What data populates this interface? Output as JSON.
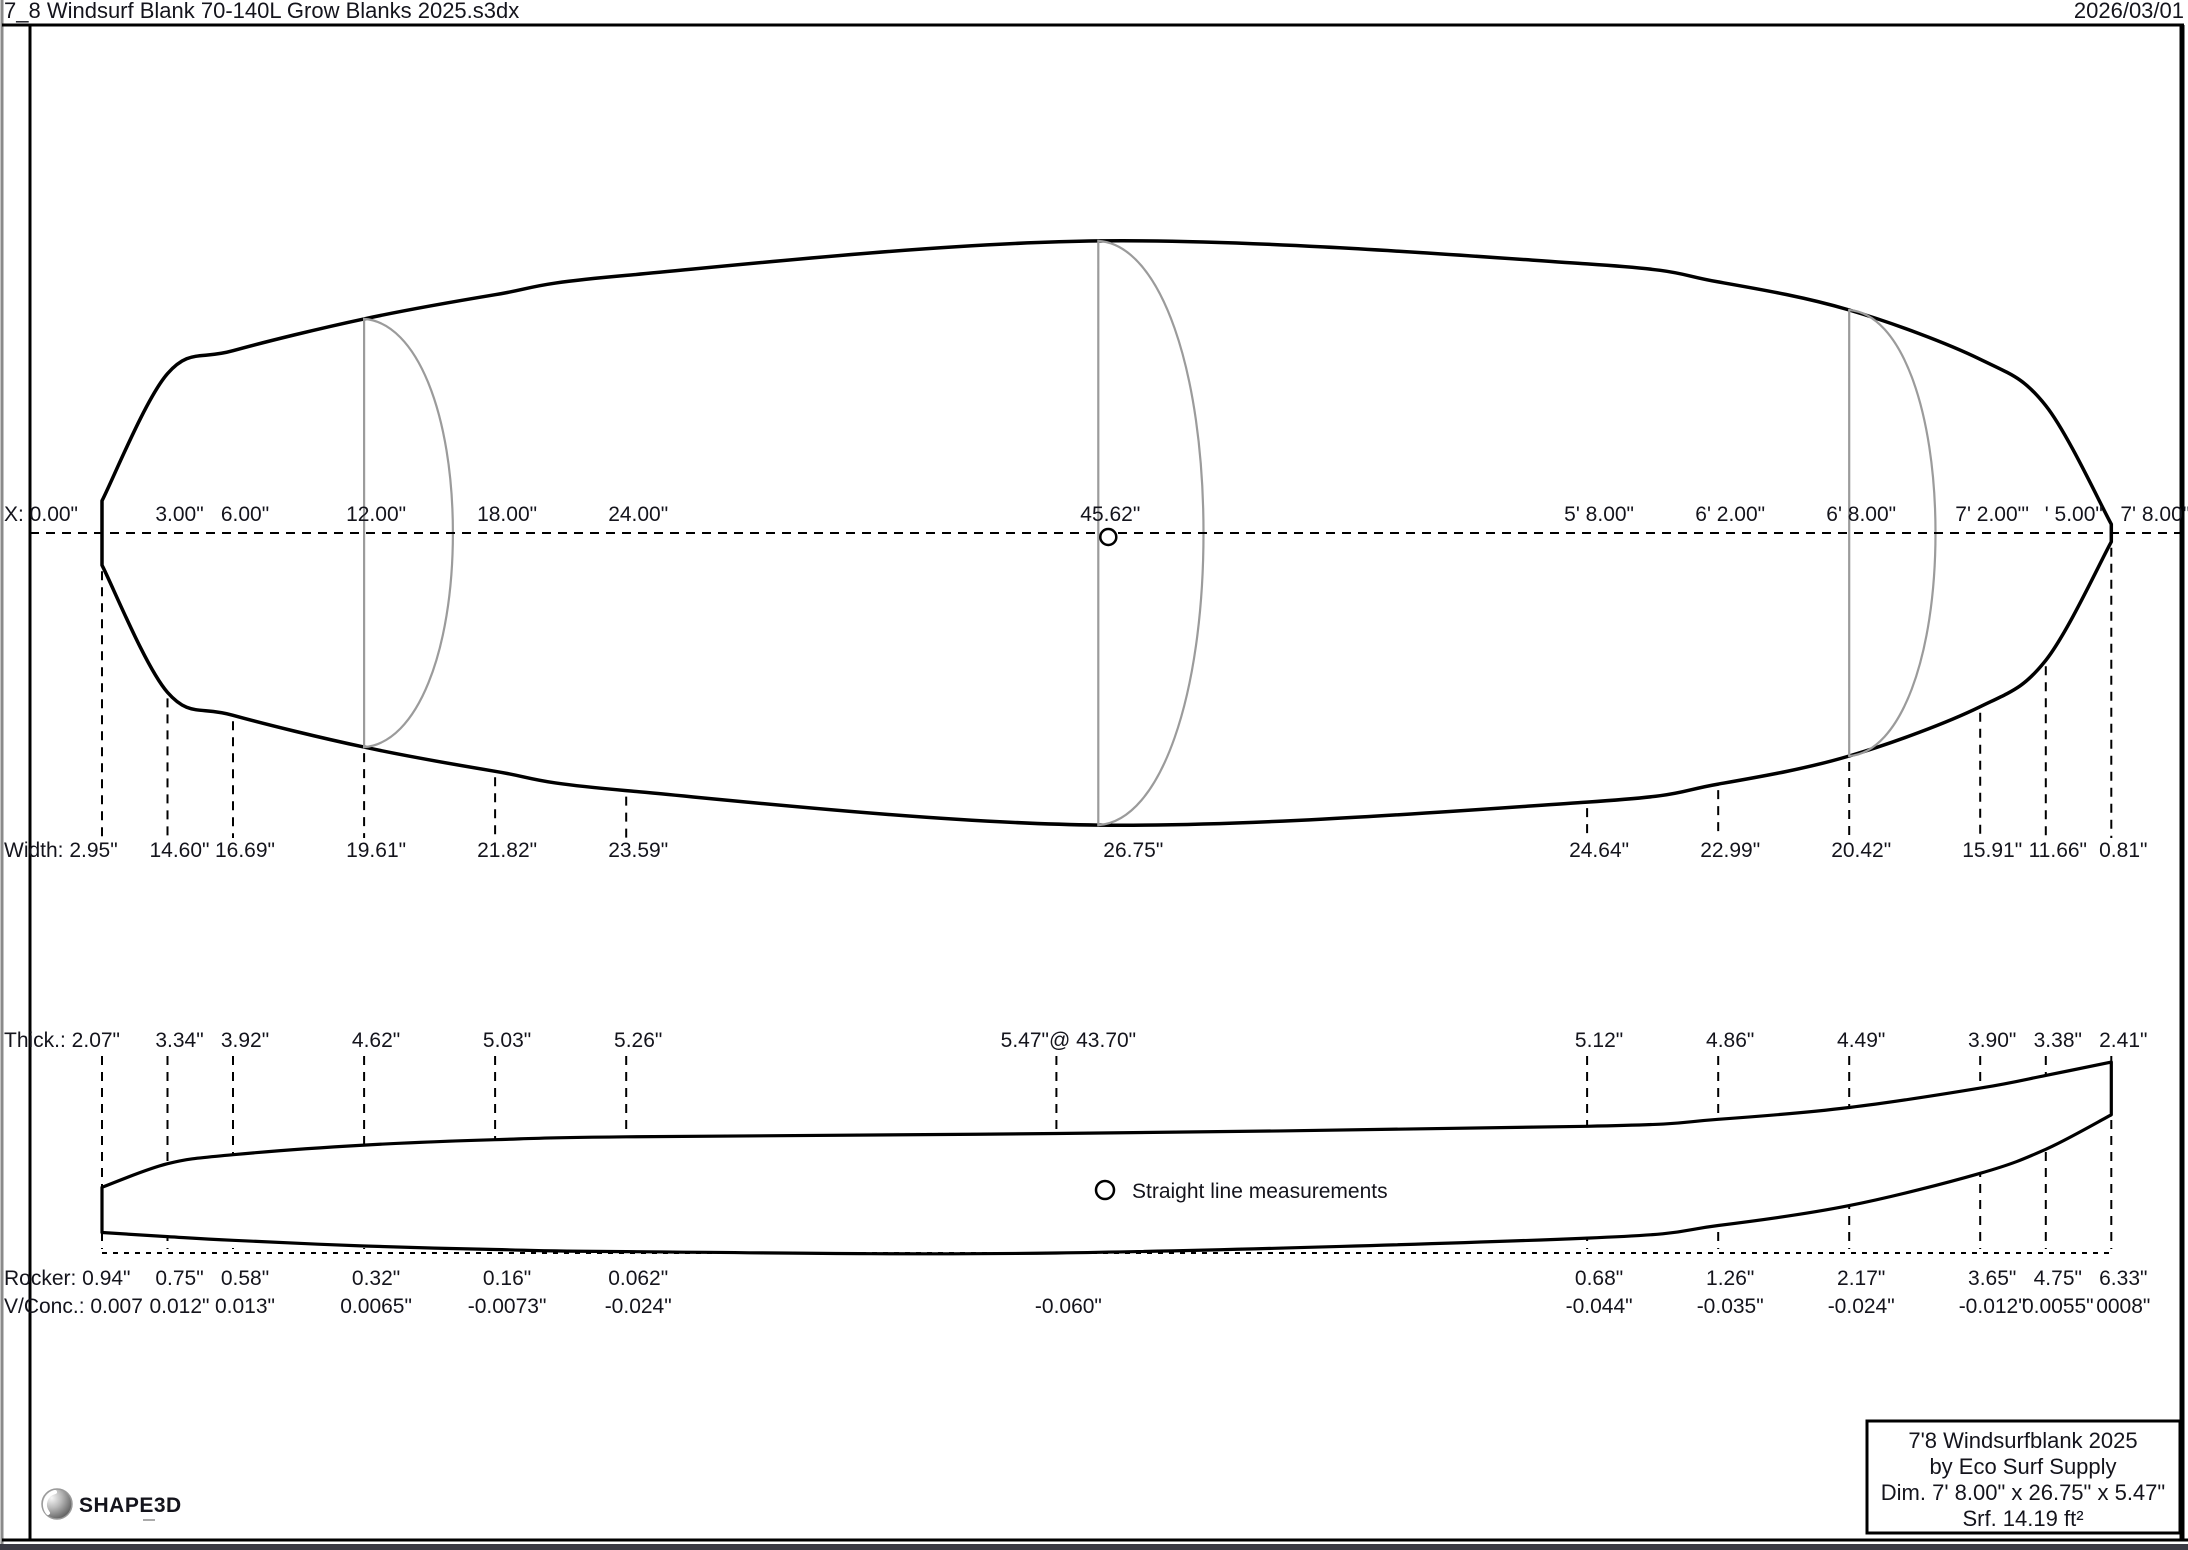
{
  "window": {
    "filename": "7_8 Windsurf Blank 70-140L Grow Blanks 2025.s3dx",
    "date": "2026/03/01"
  },
  "legend": {
    "straight_line": "Straight line measurements"
  },
  "info_box": {
    "line1": "7'8 Windsurfblank 2025",
    "line2": "by Eco Surf Supply",
    "line3": "Dim. 7' 8.00\" x 26.75\" x 5.47\"",
    "line4": "Srf. 14.19 ft²"
  },
  "logo": {
    "text": "SHAPE3D"
  },
  "chart_data": {
    "type": "technical-drawing",
    "units": "inches",
    "board": {
      "length_in": 92,
      "length_label": "7' 8.00\"",
      "max_width_in": 26.75,
      "max_thickness_in": 5.47,
      "wide_point_in": 45.62,
      "thick_point_in": 43.7,
      "surface_label": "Srf. 14.19 ft²"
    },
    "stations": [
      {
        "in": 0,
        "edge": true,
        "x": "X: 0.00\"",
        "w": "Width: 2.95\"",
        "t": "Thick.: 2.07\"",
        "r": "Rocker: 0.94\"",
        "v": "V/Conc.: 0.007",
        "wi": 2.95,
        "ti": 2.07,
        "ri": 0.94,
        "vi": 0.007
      },
      {
        "in": 3,
        "x": "3.00\"",
        "w": "14.60\"",
        "t": "3.34\"",
        "r": "0.75\"",
        "v": "0.012\"",
        "wi": 14.6,
        "ti": 3.34,
        "ri": 0.75,
        "vi": 0.012
      },
      {
        "in": 6,
        "x": "6.00\"",
        "w": "16.69\"",
        "t": "3.92\"",
        "r": "0.58\"",
        "v": "0.013\"",
        "wi": 16.69,
        "ti": 3.92,
        "ri": 0.58,
        "vi": 0.013
      },
      {
        "in": 12,
        "x": "12.00\"",
        "w": "19.61\"",
        "t": "4.62\"",
        "r": "0.32\"",
        "v": "0.0065\"",
        "wi": 19.61,
        "ti": 4.62,
        "ri": 0.32,
        "vi": 0.0065
      },
      {
        "in": 18,
        "x": "18.00\"",
        "w": "21.82\"",
        "t": "5.03\"",
        "r": "0.16\"",
        "v": "-0.0073\"",
        "wi": 21.82,
        "ti": 5.03,
        "ri": 0.16,
        "vi": -0.0073
      },
      {
        "in": 24,
        "x": "24.00\"",
        "w": "23.59\"",
        "t": "5.26\"",
        "r": "0.062\"",
        "v": "-0.024\"",
        "wi": 23.59,
        "ti": 5.26,
        "ri": 0.062,
        "vi": -0.024
      },
      {
        "in": 43.7,
        "x": null,
        "w": null,
        "t": "5.47\"@ 43.70\"",
        "r": null,
        "v": "-0.060\"",
        "wi": null,
        "ti": 5.47,
        "ri": 0.0,
        "vi": -0.06
      },
      {
        "in": 45.62,
        "x": "45.62\"",
        "w": "26.75\"",
        "t": null,
        "r": null,
        "v": null,
        "wi": 26.75,
        "ti": null,
        "ri": null,
        "vi": null,
        "dx": {
          "w": 35
        }
      },
      {
        "in": 68,
        "x": "5' 8.00\"",
        "w": "24.64\"",
        "t": "5.12\"",
        "r": "0.68\"",
        "v": "-0.044\"",
        "wi": 24.64,
        "ti": 5.12,
        "ri": 0.68,
        "vi": -0.044
      },
      {
        "in": 74,
        "x": "6' 2.00\"",
        "w": "22.99\"",
        "t": "4.86\"",
        "r": "1.26\"",
        "v": "-0.035\"",
        "wi": 22.99,
        "ti": 4.86,
        "ri": 1.26,
        "vi": -0.035
      },
      {
        "in": 80,
        "x": "6' 8.00\"",
        "w": "20.42\"",
        "t": "4.49\"",
        "r": "2.17\"",
        "v": "-0.024\"",
        "wi": 20.42,
        "ti": 4.49,
        "ri": 2.17,
        "vi": -0.024
      },
      {
        "in": 86,
        "x": "7' 2.00\"'",
        "w": "15.91\"",
        "t": "3.90\"",
        "r": "3.65\"",
        "v": "-0.012\"",
        "wi": 15.91,
        "ti": 3.9,
        "ri": 3.65,
        "vi": -0.012
      },
      {
        "in": 89,
        "x": "' 5.00\"",
        "w": "11.66\"",
        "t": "3.38\"",
        "r": "4.75\"",
        "v": "0.0055\"",
        "wi": 11.66,
        "ti": 3.38,
        "ri": 4.75,
        "vi": 0.0055,
        "dx": {
          "x": 28
        }
      },
      {
        "in": 92,
        "x": "7' 8.00\"",
        "w": "0.81\"",
        "t": "2.41\"",
        "r": "6.33\"",
        "v": "0008\"",
        "wi": 0.81,
        "ti": 2.41,
        "ri": 6.33,
        "vi": 0.0008,
        "dx": {
          "x": 44
        }
      }
    ],
    "slices": [
      {
        "pos_in": 12,
        "width_in": 19.61,
        "thick_in": 4.62
      },
      {
        "pos_in": 45.62,
        "width_in": 26.75,
        "thick_in": 5.47
      },
      {
        "pos_in": 80,
        "width_in": 20.42,
        "thick_in": 4.49
      }
    ]
  }
}
